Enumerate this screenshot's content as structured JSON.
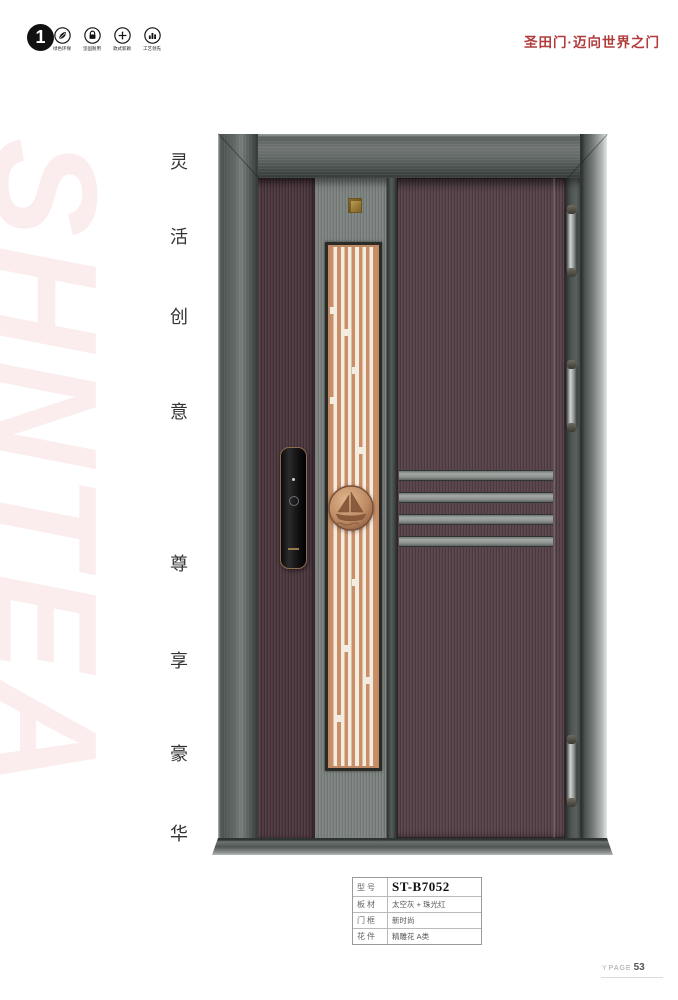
{
  "header": {
    "badge_number": "1",
    "features": [
      {
        "icon": "leaf-icon",
        "label": "绿色环保"
      },
      {
        "icon": "lock-icon",
        "label": "坚固耐用"
      },
      {
        "icon": "plus-icon",
        "label": "款式新颖"
      },
      {
        "icon": "chart-icon",
        "label": "工艺领先"
      }
    ],
    "brand_slogan": "圣田门·迈向世界之门"
  },
  "watermark_text": "SHNTEA",
  "vertical_slogan": [
    "灵",
    "活",
    "创",
    "意",
    "尊",
    "享",
    "豪",
    "华"
  ],
  "product_specs": {
    "rows": [
      {
        "label": "型号",
        "value": "ST-B7052"
      },
      {
        "label": "板材",
        "value": "太空灰 + 珠光红"
      },
      {
        "label": "门框",
        "value": "新时尚"
      },
      {
        "label": "花件",
        "value": "精雕花 A类"
      }
    ]
  },
  "footer": {
    "mark": "Y",
    "page_label": "PAGE",
    "page_number": "53"
  },
  "colors": {
    "brand_red": "#b23c3c",
    "watermark_pink": "#fbeced",
    "door_brown": "#5a454c",
    "grille_copper": "#ca8f66",
    "frame_gray": "#5a605e",
    "gold_plate": "#caa95f"
  }
}
